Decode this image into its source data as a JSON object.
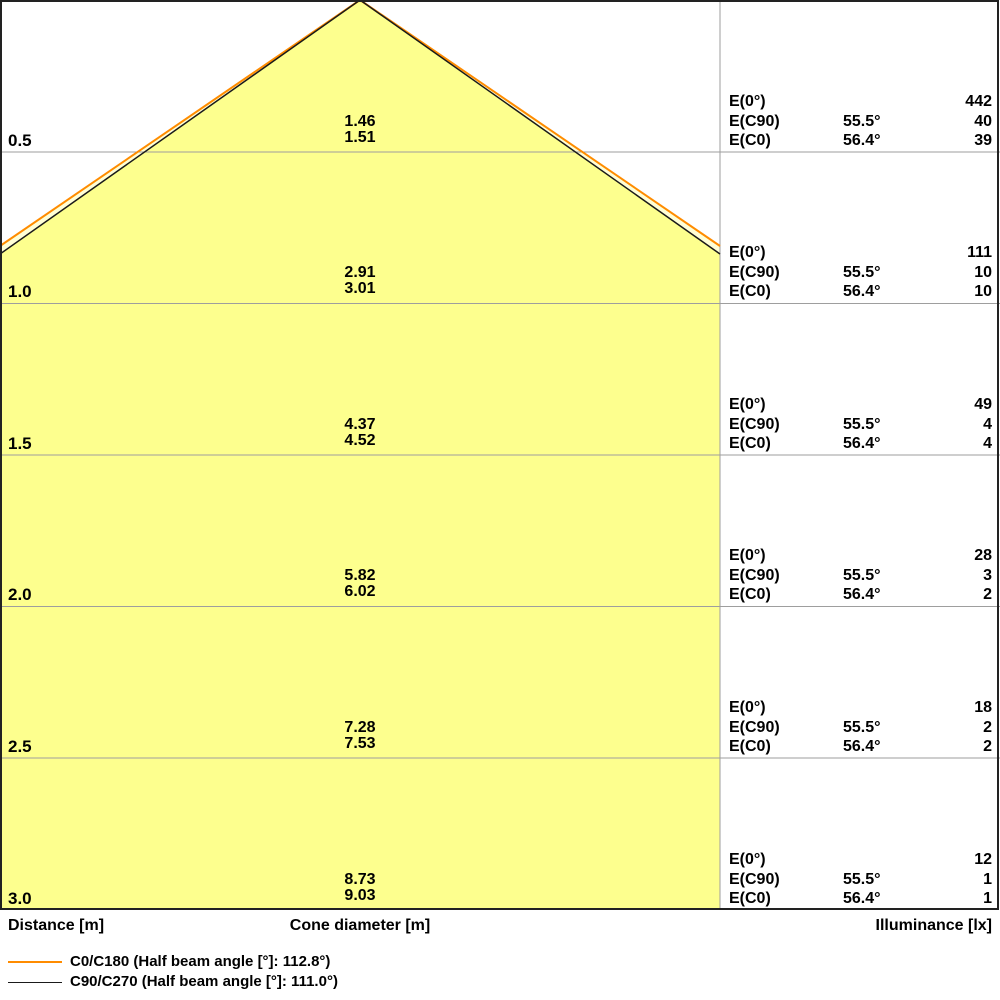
{
  "axis_labels": {
    "distance": "Distance [m]",
    "cone_diameter": "Cone diameter [m]",
    "illuminance": "Illuminance [lx]"
  },
  "row_labels": {
    "e0": "E(0°)",
    "ec90": "E(C90)",
    "ec0": "E(C0)"
  },
  "legend": [
    {
      "name": "C0/C180",
      "label": "C0/C180 (Half beam angle [°]: 112.8°)",
      "color": "#FF8C00"
    },
    {
      "name": "C90/C270",
      "label": "C90/C270 (Half beam angle [°]: 111.0°)",
      "color": "#1A1A1A"
    }
  ],
  "colors": {
    "cone_fill": "#FDFF8E",
    "cone_fill_outer": "#FFFFD6",
    "c0_line": "#FF8C00",
    "c90_line": "#1A1A1A",
    "grid_line": "#9E9E9E",
    "border": "#222222"
  },
  "rows": [
    {
      "distance": "0.5",
      "diameter_c90": "1.46",
      "diameter_c0": "1.51",
      "e0": "442",
      "ec90_angle": "55.5°",
      "ec90": "40",
      "ec0_angle": "56.4°",
      "ec0": "39"
    },
    {
      "distance": "1.0",
      "diameter_c90": "2.91",
      "diameter_c0": "3.01",
      "e0": "111",
      "ec90_angle": "55.5°",
      "ec90": "10",
      "ec0_angle": "56.4°",
      "ec0": "10"
    },
    {
      "distance": "1.5",
      "diameter_c90": "4.37",
      "diameter_c0": "4.52",
      "e0": "49",
      "ec90_angle": "55.5°",
      "ec90": "4",
      "ec0_angle": "56.4°",
      "ec0": "4"
    },
    {
      "distance": "2.0",
      "diameter_c90": "5.82",
      "diameter_c0": "6.02",
      "e0": "28",
      "ec90_angle": "55.5°",
      "ec90": "3",
      "ec0_angle": "56.4°",
      "ec0": "2"
    },
    {
      "distance": "2.5",
      "diameter_c90": "7.28",
      "diameter_c0": "7.53",
      "e0": "18",
      "ec90_angle": "55.5°",
      "ec90": "2",
      "ec0_angle": "56.4°",
      "ec0": "2"
    },
    {
      "distance": "3.0",
      "diameter_c90": "8.73",
      "diameter_c0": "9.03",
      "e0": "12",
      "ec90_angle": "55.5°",
      "ec90": "1",
      "ec0_angle": "56.4°",
      "ec0": "1"
    }
  ],
  "chart_data": {
    "type": "cone-diagram",
    "title": "Luminaire light cone diagram",
    "xlabel": "Cone diameter [m]",
    "ylabel": "Distance [m]",
    "distances_m": [
      0.5,
      1.0,
      1.5,
      2.0,
      2.5,
      3.0
    ],
    "series": [
      {
        "name": "C90/C270",
        "half_beam_angle_deg": 111.0,
        "half_angle_deg": 55.5,
        "cone_diameter_m": [
          1.46,
          2.91,
          4.37,
          5.82,
          7.28,
          8.73
        ],
        "illuminance_lx": [
          40,
          10,
          4,
          3,
          2,
          1
        ],
        "color": "#1A1A1A"
      },
      {
        "name": "C0/C180",
        "half_beam_angle_deg": 112.8,
        "half_angle_deg": 56.4,
        "cone_diameter_m": [
          1.51,
          3.01,
          4.52,
          6.02,
          7.53,
          9.03
        ],
        "illuminance_lx": [
          39,
          10,
          4,
          2,
          2,
          1
        ],
        "color": "#FF8C00"
      },
      {
        "name": "E(0°)",
        "illuminance_lx": [
          442,
          111,
          49,
          28,
          18,
          12
        ]
      }
    ],
    "layout": {
      "grid": true,
      "legend_position": "bottom-left",
      "cone_apex_px": [
        360,
        0
      ],
      "row_line_y_px": [
        152,
        303.5,
        455,
        606.5,
        758,
        910
      ],
      "panel_divider_x_px": 720
    }
  }
}
